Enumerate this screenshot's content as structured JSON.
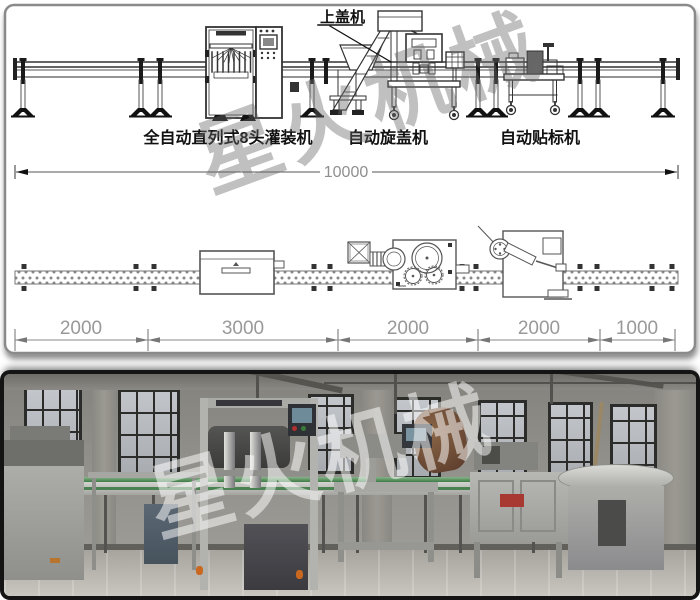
{
  "diagram": {
    "callout_cap_feeder": "上盖机",
    "label_filling": "全自动直列式8头灌装机",
    "label_capping": "自动旋盖机",
    "label_labeling": "自动贴标机",
    "dim_total": "10000",
    "dim_segments": [
      "2000",
      "3000",
      "2000",
      "2000",
      "1000"
    ],
    "watermark": "星火机械"
  },
  "photo": {
    "watermark": "星火机械"
  },
  "colors": {
    "drawing_line": "#3c3c3c",
    "dim_text": "#8f8f8f",
    "watermark_gray": "rgba(105,105,105,0.42)",
    "watermark_white": "rgba(255,255,255,0.52)",
    "conveyor_green": "#4a8150",
    "photo_frame": "#141414"
  }
}
